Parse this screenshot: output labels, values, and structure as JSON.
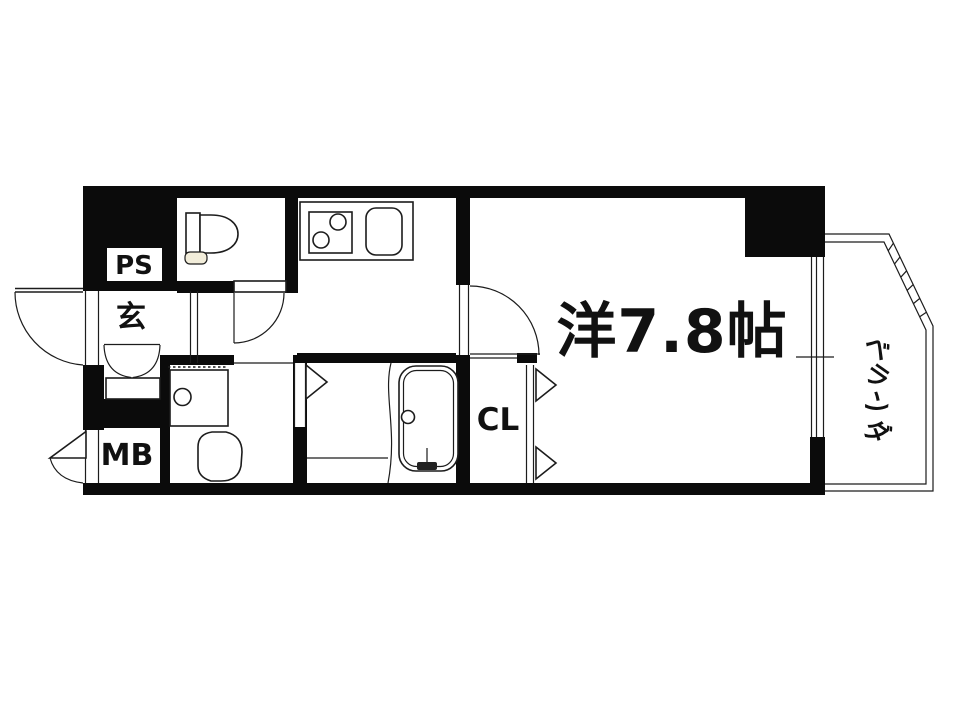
{
  "plan": {
    "title": "apartment-floor-plan",
    "rooms": {
      "main_room": {
        "label": "洋7.8帖"
      },
      "veranda": {
        "label": "ベランダ",
        "chars": [
          "ベ",
          "ラ",
          "ン",
          "ダ"
        ]
      },
      "entrance": {
        "label": "玄"
      },
      "pipe_space": {
        "label": "PS"
      },
      "meter_box": {
        "label": "MB"
      },
      "closet": {
        "label": "CL"
      }
    },
    "fixtures": [
      "toilet",
      "kitchen-stove",
      "kitchen-sink",
      "bathtub",
      "washer-pan",
      "washbasin",
      "shoe-cabinet"
    ],
    "colors": {
      "wall": "#0b0b0b",
      "line": "#1c1c1c",
      "background": "#ffffff",
      "toilet_base": "#f2edda"
    }
  }
}
